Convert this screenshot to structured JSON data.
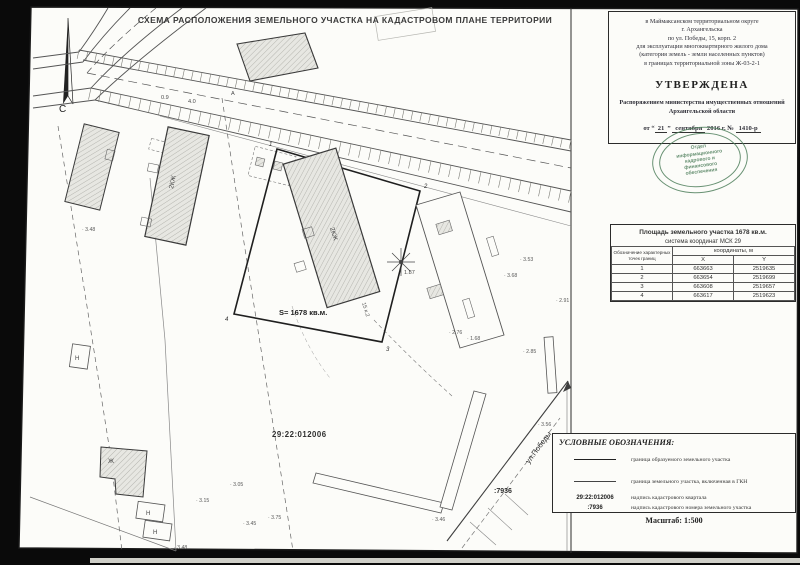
{
  "title": "СХЕМА РАСПОЛОЖЕНИЯ ЗЕМЕЛЬНОГО УЧАСТКА НА КАДАСТРОВОМ ПЛАНЕ ТЕРРИТОРИИ",
  "approval": {
    "location_lines": [
      "в Маймаксанском территориальном округе",
      "г. Архангельска",
      "по ул. Победы, 15, корп. 2",
      "для эксплуатации многоквартирного жилого дома",
      "(категория земель - земли населенных пунктов)",
      "в границах территориальной зоны Ж-03-2-1"
    ],
    "approved_word": "УТВЕРЖДЕНА",
    "order_line1": "Распоряжением министерства имущественных отношений",
    "order_line2": "Архангельской области",
    "date_from": "от “",
    "date_day": "21",
    "date_close": "”",
    "date_month": "сентября",
    "date_year": "2016 г. №",
    "date_number": "1410-р"
  },
  "stamp": {
    "lines": [
      "Отдел",
      "информационного",
      "кадрового и",
      "финансового",
      "обеспечения"
    ],
    "color": "#4f7f5c"
  },
  "area_table": {
    "title": "Площадь земельного участка  1678 кв.м.",
    "coord_system": "система координат МСК 29",
    "coords_header": "координаты, м",
    "point_col_header": "Обозначение характерных точек границ",
    "x_header": "X",
    "y_header": "Y",
    "rows": [
      {
        "n": "1",
        "x": "663663",
        "y": "2519635"
      },
      {
        "n": "2",
        "x": "663654",
        "y": "2519699"
      },
      {
        "n": "3",
        "x": "663608",
        "y": "2519657"
      },
      {
        "n": "4",
        "x": "663617",
        "y": "2519623"
      }
    ]
  },
  "legend": {
    "header": "УСЛОВНЫЕ ОБОЗНАЧЕНИЯ:",
    "items": [
      {
        "symbol": "line",
        "label": "граница образуемого земельного участка"
      },
      {
        "symbol": "line",
        "label": "граница земельного участка, включенная в ГКН"
      },
      {
        "symbol": "29:22:012006",
        "label": "надпись кадастрового квартала"
      },
      {
        "symbol": ":7936",
        "label": "надпись кадастрового номера земельного участка"
      }
    ],
    "scale": "Масштаб: 1:500"
  },
  "map": {
    "north": "С",
    "quarter": "29:22:012006",
    "area": "S=  1678 кв.м.",
    "cad_number": ":7936",
    "street": "ул.Победы",
    "bld2kzh": "2КЖ",
    "house": "15 к.2",
    "zh": "Ж",
    "n": "Н",
    "points": [
      {
        "n": "1"
      },
      {
        "n": "2"
      },
      {
        "n": "3"
      },
      {
        "n": "4"
      }
    ],
    "elevation_marks": [
      {
        "x": 82,
        "y": 231,
        "v": "3.48"
      },
      {
        "x": 230,
        "y": 486,
        "v": "3.05"
      },
      {
        "x": 196,
        "y": 502,
        "v": "3.15"
      },
      {
        "x": 174,
        "y": 549,
        "v": "3.48"
      },
      {
        "x": 243,
        "y": 525,
        "v": "3.45"
      },
      {
        "x": 268,
        "y": 519,
        "v": "3.75"
      },
      {
        "x": 432,
        "y": 521,
        "v": "3.46"
      },
      {
        "x": 449,
        "y": 334,
        "v": "2.76"
      },
      {
        "x": 467,
        "y": 340,
        "v": "1.68"
      },
      {
        "x": 520,
        "y": 261,
        "v": "3.53"
      },
      {
        "x": 504,
        "y": 277,
        "v": "3.68"
      },
      {
        "x": 538,
        "y": 426,
        "v": "3.56"
      },
      {
        "x": 556,
        "y": 302,
        "v": "2.91"
      },
      {
        "x": 523,
        "y": 353,
        "v": "2.85"
      }
    ],
    "road_labels": [
      {
        "x": 161,
        "y": 99,
        "v": "0.9"
      },
      {
        "x": 188,
        "y": 103,
        "v": "4.0"
      },
      {
        "x": 231,
        "y": 95,
        "v": "А"
      },
      {
        "x": 404,
        "y": 274,
        "v": "1.87"
      }
    ]
  }
}
